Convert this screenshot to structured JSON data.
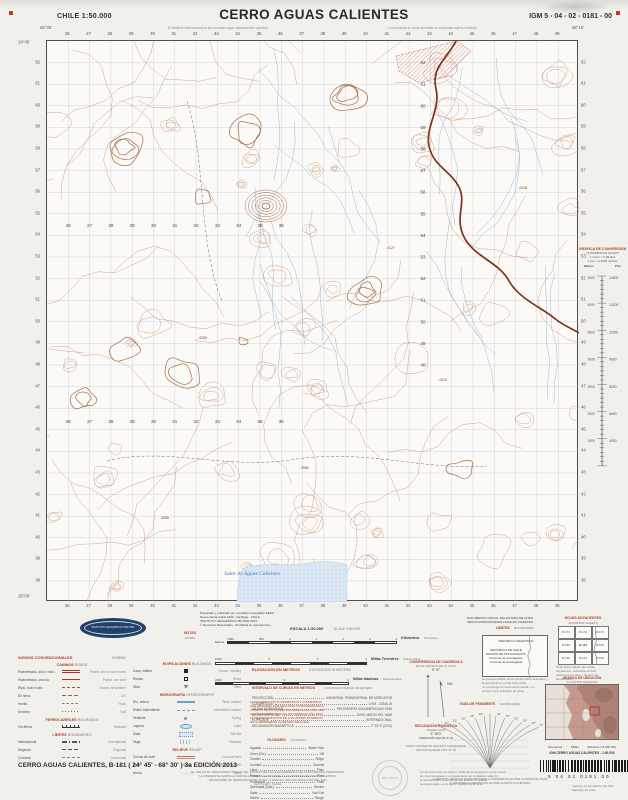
{
  "header": {
    "country_scale": "CHILE  1:50.000",
    "title": "CERRO AGUAS CALIENTES",
    "sheet_code": "IGM 5 - 04 - 02 - 0181 - 00"
  },
  "edge_notes": [
    "El deslinde internacional ha sido trazado según antecedentes vigentes",
    "La toponimia de zonas limítrofes se encuentra sujeta a revisión"
  ],
  "map": {
    "eastings": [
      "26",
      "27",
      "28",
      "29",
      "30",
      "31",
      "32",
      "33",
      "34",
      "35",
      "36",
      "37",
      "38",
      "39",
      "40",
      "41",
      "42",
      "43",
      "44",
      "45",
      "46",
      "47",
      "48",
      "49"
    ],
    "northings": [
      "62",
      "61",
      "60",
      "59",
      "58",
      "57",
      "56",
      "55",
      "54",
      "53",
      "52",
      "51",
      "50",
      "49",
      "48",
      "47",
      "46",
      "45",
      "44",
      "43",
      "42",
      "41",
      "40",
      "39",
      "38"
    ],
    "corner_tl_lon": "68°30'",
    "corner_tr_lon": "68°15'",
    "corner_tl_lat": "24°45'",
    "corner_bl_lat": "25°00'",
    "salar_label": "Salar de Aguas Calientes",
    "spot_heights": [
      {
        "v": "4265",
        "x": 150,
        "y": 298
      },
      {
        "v": "4127",
        "x": 338,
        "y": 208
      },
      {
        "v": "3980",
        "x": 252,
        "y": 428
      },
      {
        "v": "4418",
        "x": 470,
        "y": 148
      },
      {
        "v": "4086",
        "x": 112,
        "y": 478
      },
      {
        "v": "4310",
        "x": 390,
        "y": 340
      }
    ]
  },
  "conversion": {
    "title": "GRÁFICA DE CONVERSIÓN",
    "subtitle": "CONVERSION GRAPH",
    "eq1": "1 metro = 3,28 pies",
    "eq2": "1 pie = 0,3048 metros",
    "col_left": "Metros",
    "col_right": "Pies",
    "metros": [
      "4500",
      "4000",
      "3500",
      "3000",
      "2500",
      "2000",
      "1500"
    ],
    "pies": [
      "14800",
      "13100",
      "11500",
      "9800",
      "8200",
      "6600",
      "4900"
    ]
  },
  "credits": {
    "lines": [
      "Preparado y publicado por el Instituto Geográfico Militar.",
      "Nueva Santa Isabel 1640 - Santiago - CHILE.",
      "INSTITUTO GEOGRÁFICO MILITAR 2013.",
      "© Derechos Reservados - Prohibida su reproducción."
    ]
  },
  "official": {
    "lines": [
      "DOCUMENTO OFICIAL DEL ESTADO DE CHILE",
      "SEGÚN DISPOSICIONES LEGALES VIGENTES"
    ]
  },
  "notas": {
    "es": "NOTAS",
    "en": "NOTES"
  },
  "escala": {
    "title_es": "ESCALA 1:50.000",
    "title_en": "SCALE 1:50.000",
    "metros_label": "Metros",
    "bars": [
      {
        "numbers": [
          "1000",
          "500",
          "0",
          "1",
          "2",
          "3",
          "4"
        ],
        "label_es": "Kilómetros",
        "label_en": "Kilometers"
      },
      {
        "numbers": [
          "1000",
          "0",
          "1",
          "2"
        ],
        "label_es": "Millas Terrestres",
        "label_en": "Statute Miles"
      },
      {
        "numbers": [
          "2000",
          "0",
          "1"
        ],
        "label_es": "Millas Náuticas",
        "label_en": "Nautical Miles"
      }
    ]
  },
  "signos": {
    "title": "SIGNOS CONVENCIONALES",
    "title_en": "LEGEND",
    "col1": [
      {
        "header": "CAMINOS",
        "header_en": "ROADS",
        "items": [
          {
            "es": "Pavimentado, dos o más vías",
            "en": "Paved, two or more lanes",
            "sym": "road2"
          },
          {
            "es": "Pavimentado, una vía",
            "en": "Paved, one lane",
            "sym": "road1"
          },
          {
            "es": "Ripio, todo el año",
            "en": "Gravel, all weather",
            "sym": "gravel"
          },
          {
            "es": "De tierra",
            "en": "Dirt",
            "sym": "dirt"
          },
          {
            "es": "Huella",
            "en": "Track",
            "sym": "track"
          },
          {
            "es": "Sendero",
            "en": "Trail",
            "sym": "trail"
          }
        ]
      },
      {
        "header": "FERROCARRILES",
        "header_en": "RAILROADS",
        "items": [
          {
            "es": "Vía férrea",
            "en": "Railroad",
            "sym": "rail"
          }
        ]
      },
      {
        "header": "LÍMITES",
        "header_en": "BOUNDARIES",
        "items": [
          {
            "es": "Internacional",
            "en": "International",
            "sym": "bint"
          },
          {
            "es": "Regional",
            "en": "Regional",
            "sym": "breg"
          },
          {
            "es": "Comunal",
            "en": "Communal",
            "sym": "bcom"
          }
        ]
      }
    ],
    "col2": [
      {
        "header": "EDIFICACIONES",
        "header_en": "BUILDINGS",
        "items": [
          {
            "es": "Casa, edificio",
            "en": "House, building",
            "sym": "bld"
          },
          {
            "es": "Ruinas",
            "en": "Ruins",
            "sym": "ruin"
          },
          {
            "es": "Mina",
            "en": "Mine",
            "sym": "mine"
          }
        ]
      },
      {
        "header": "HIDROGRAFÍA",
        "header_en": "HYDROGRAPHY",
        "items": [
          {
            "es": "Río, estero",
            "en": "River, stream",
            "sym": "riv"
          },
          {
            "es": "Estero intermitente",
            "en": "Intermittent stream",
            "sym": "ist"
          },
          {
            "es": "Vertiente",
            "en": "Spring",
            "sym": "spr"
          },
          {
            "es": "Laguna",
            "en": "Lake",
            "sym": "lake"
          },
          {
            "es": "Salar",
            "en": "Salt flat",
            "sym": "salar"
          },
          {
            "es": "Vega",
            "en": "Meadow",
            "sym": "vega"
          }
        ]
      },
      {
        "header": "RELIEVE",
        "header_en": "RELIEF",
        "items": [
          {
            "es": "Curvas de nivel",
            "en": "Contour lines",
            "sym": "cont"
          },
          {
            "es": "Cota",
            "en": "Spot elevation",
            "sym": "spot"
          },
          {
            "es": "Arena",
            "en": "Sand",
            "sym": "sand"
          }
        ]
      }
    ]
  },
  "geo_notes": {
    "lines": [
      "LA INFORMACIÓN PLANIMÉTRICA Y ALTIMÉTRICA",
      "FUE OBTENIDA POR MÉTODOS FOTOGRAMÉTRICOS",
      "A PARTIR DE FOTOGRAFÍAS AÉREAS DEL AÑO 1996.",
      "ACTUALIZACIÓN PARCIAL DE TERRENO AÑO 2013.",
      "LA REPRESENTACIÓN DE LOS LÍMITES INTERNOS",
      "NO COMPROMETE AL ESTADO DE CHILE."
    ]
  },
  "glosario": {
    "title": "GLOSARIO",
    "title_en": "GLOSSARY",
    "rows": [
      {
        "es": "Aguada",
        "en": "Water Hole"
      },
      {
        "es": "Cerro (Co.)",
        "en": "Hill"
      },
      {
        "es": "Cordón",
        "en": "Ridge"
      },
      {
        "es": "Cumbre",
        "en": "Summit"
      },
      {
        "es": "Llano",
        "en": "Plain"
      },
      {
        "es": "Pampa",
        "en": "Plain"
      },
      {
        "es": "Portezuelo",
        "en": "Pass"
      },
      {
        "es": "Quebrada (Qda.)",
        "en": "Ravine"
      },
      {
        "es": "Salar",
        "en": "Salt Flat"
      },
      {
        "es": "Sierra",
        "en": "Range"
      },
      {
        "es": "Vega",
        "en": "Meadow"
      },
      {
        "es": "Volcán (Vn.)",
        "en": "Volcano"
      }
    ]
  },
  "elev": {
    "title_es": "ELEVACIÓN EN METROS",
    "title_en": "ELEVATIONS IN METERS",
    "interval_es": "INTERVALO DE CURVAS EN METROS",
    "interval_en": "CONTOUR INTERVAL 50 METERS",
    "rows": [
      {
        "k": "PROYECCIÓN",
        "v": "UNIVERSAL TRANSVERSAL DE MERCATOR"
      },
      {
        "k": "CUADRÍCULA",
        "v": "UTM - ZONA 19"
      },
      {
        "k": "DATUM HORIZONTAL",
        "v": "PROVISORIO SUDAMERICANO 1956"
      },
      {
        "k": "DATUM VERTICAL",
        "v": "NIVEL MEDIO DEL MAR"
      },
      {
        "k": "ELIPSOIDE",
        "v": "INTERNACIONAL"
      },
      {
        "k": "DECLINACIÓN MAGNÉTICA",
        "v": "2° 18' E (2013)"
      }
    ]
  },
  "convergencia": {
    "title1": "CONVERGENCIA DE CUADRÍCULA",
    "sub1": "EN EL CENTRO DE LA HOJA",
    "val1": "0° 47'",
    "title2": "DECLINACIÓN MAGNÉTICA",
    "sub2": "ENERO 2013",
    "val2": "2° 18' E",
    "note": "VARIACIÓN ANUAL 8' W",
    "conv_note": "PARA CONVERTIR GRADOS A MILÉSIMAS MULTIPLÍQUESE POR 17,78"
  },
  "limites": {
    "title": "LÍMITES",
    "title_en": "BOUNDARIES",
    "argentina": "REPÚBLICA  ARGENTINA",
    "lines": [
      "REPÚBLICA DE CHILE",
      "REGIÓN DE ANTOFAGASTA",
      "Provincia de Antofagasta",
      "Comuna de Antofagasta"
    ],
    "footnote": [
      "La representación de los límites internacionales y la toponimia en zonas fronterizas",
      "no constituye un documento oficial y no compromete al Estado de Chile."
    ]
  },
  "hojas": {
    "title": "HOJAS ADYACENTES",
    "title_en": "ADJOINING SHEETS",
    "cells": [
      "B-171",
      "B-172",
      "B-173",
      "B-180",
      "B-181",
      "B-182",
      "B-190",
      "B-191",
      "B-192"
    ],
    "footnote": [
      "Nota: Para adquirir las cartas adyacentes, solicítelas al IGM",
      "citando su nombre y número de identificación."
    ]
  },
  "pendiente": {
    "title": "GUÍA DE PENDIENTE",
    "title_en": "SLOPE GUIDE",
    "left_labels": [
      "30°",
      "25°",
      "20°",
      "15°",
      "10°",
      "5°"
    ],
    "right_labels": [
      "5°",
      "10°",
      "15°",
      "20°",
      "25°",
      "30°"
    ],
    "footnote_a": "a) MÉTODO GRÁFICO PARA OBTENER LA PENDIENTE ENTRE CURVAS DE NIVEL",
    "footnote_b": "b) DISTANCIA HORIZONTAL ENTRE CURVAS SUCESIVAS",
    "para": [
      "Su aproximación se obtiene midiendo la separación entre curvas",
      "de nivel sucesivas y comparándola con el abanico adjunto;",
      "la lectura indica la pendiente del terreno en grados",
      "sexagesimales, en el sector medido de la carta."
    ]
  },
  "ubicacion": {
    "title": "GRÁFICA DE UBICACIÓN",
    "title_en": "LOCATION DIAGRAM",
    "scale_note": "ESCALA 1:5.000.000",
    "km_label": "Kilómetros",
    "mi_label": "Millas",
    "igm_line": "IGM   CERRO AGUAS CALIENTES  -  1:50.000",
    "barcode_digits": "5   04   02   0181   00",
    "imprint": [
      "Impreso en los talleres del IGM",
      "Santiago de Chile"
    ]
  },
  "center_note": {
    "lines": [
      "EL IGM ES EL ORGANISMO OFICIAL DEL ESTADO DE CHILE EN MATERIAS DE CARTOGRAFÍA TERRESTRE.",
      "LA PRESENTE CARTA HA SIDO ELABORADA CONFORME A LAS NORMAS TÉCNICAS VIGENTES.",
      "SE PROHÍBE SU REPRODUCCIÓN TOTAL O PARCIAL SIN AUTORIZACIÓN DEL IGM.",
      "SANTIAGO - CHILE."
    ]
  },
  "stamp": {
    "label": "BIBLIOTECA"
  },
  "edition": {
    "line": "CERRO AGUAS CALIENTES, B-181 ( 24° 45' - 68° 30' ) 3a EDICIÓN 2013"
  },
  "colors": {
    "contour": "#c98f72",
    "contour_index": "#a96a48",
    "grid": "#b7c3d3",
    "water": "#86abc9",
    "road": "#7e331c",
    "salar_fill": "#dbe8f4",
    "lava": "#c05040",
    "legend_red": "#a8402c",
    "navy": "#23406b"
  }
}
